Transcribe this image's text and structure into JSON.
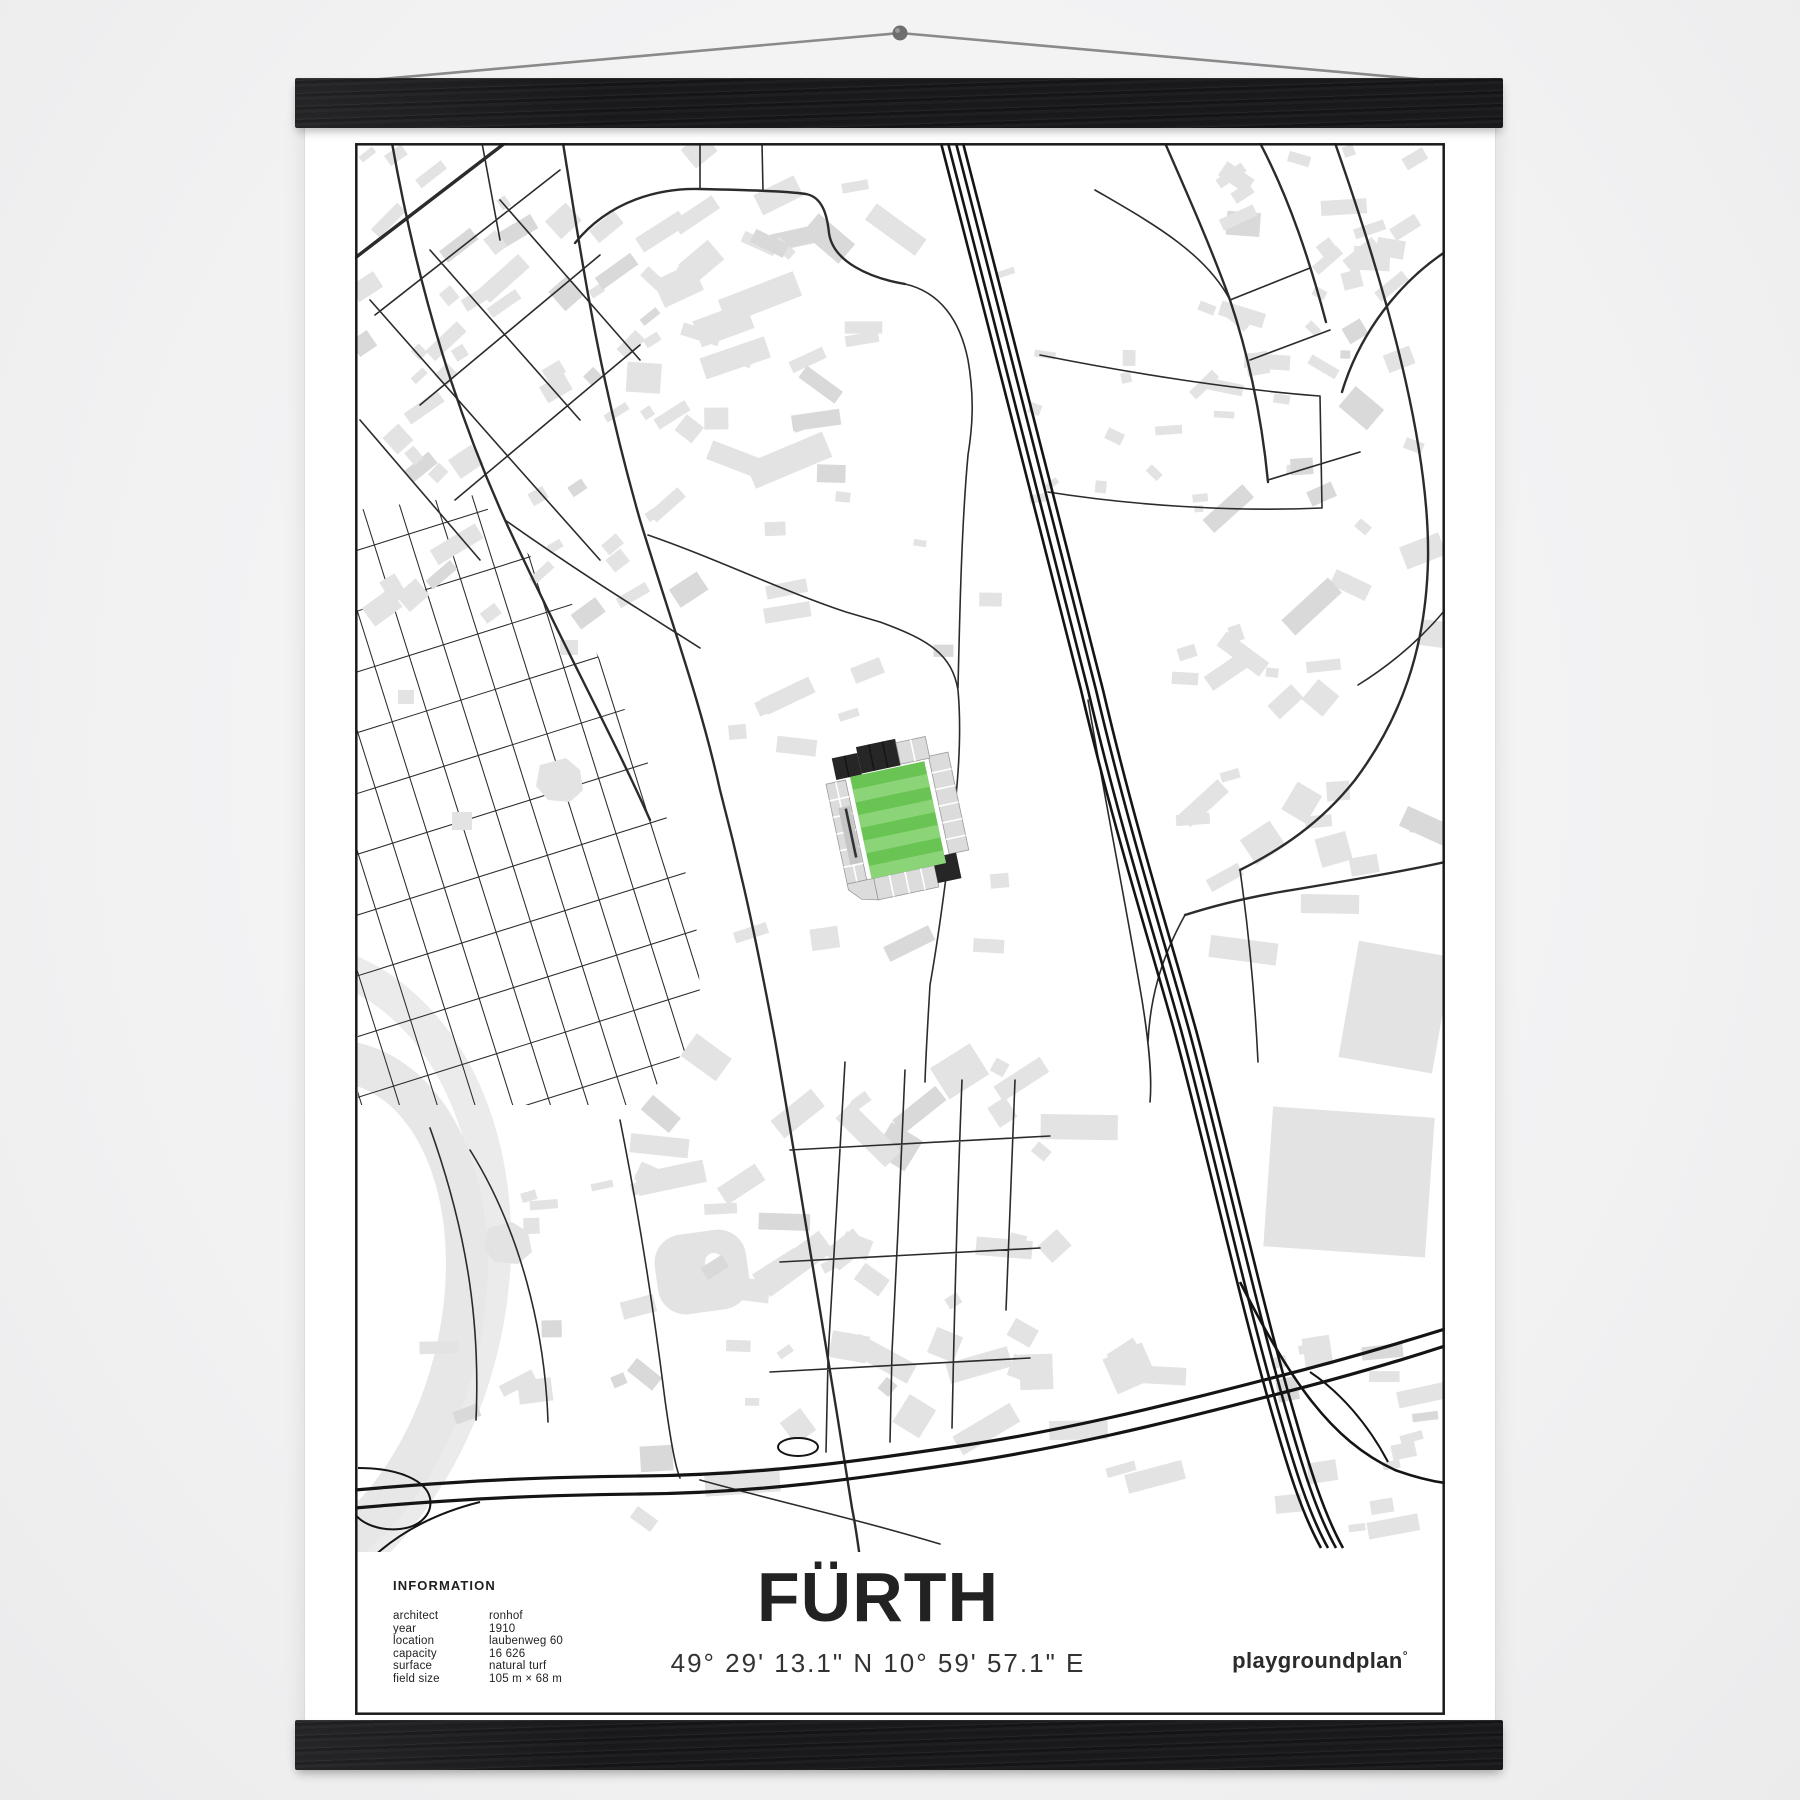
{
  "poster": {
    "title": "FÜRTH",
    "coordinates": "49° 29' 13.1\" N  10° 59' 57.1\" E",
    "brand": {
      "name": "playgroundplan",
      "mark": "°"
    },
    "information": {
      "heading": "INFORMATION",
      "rows": [
        {
          "label": "architect",
          "value": "ronhof"
        },
        {
          "label": "year",
          "value": "1910"
        },
        {
          "label": "location",
          "value": "laubenweg 60"
        },
        {
          "label": "capacity",
          "value": "16 626"
        },
        {
          "label": "surface",
          "value": "natural turf"
        },
        {
          "label": "field size",
          "value": "105 m × 68 m"
        }
      ]
    }
  },
  "colors": {
    "pitch_green": "#69c454",
    "pitch_stripe": "#8bd477",
    "stand_gray": "#dcdcdc",
    "stand_dark": "#262626",
    "building_gray": "#e3e3e3",
    "road_black": "#2b2b2b",
    "rail_black": "#141414",
    "frame_black": "#1a1a1a",
    "track_gray": "#e7e7e7",
    "paper_white": "#ffffff",
    "wood_black": "#1a1a1c",
    "string_gray": "#8a8a8a",
    "text_black": "#1f1f1f"
  }
}
